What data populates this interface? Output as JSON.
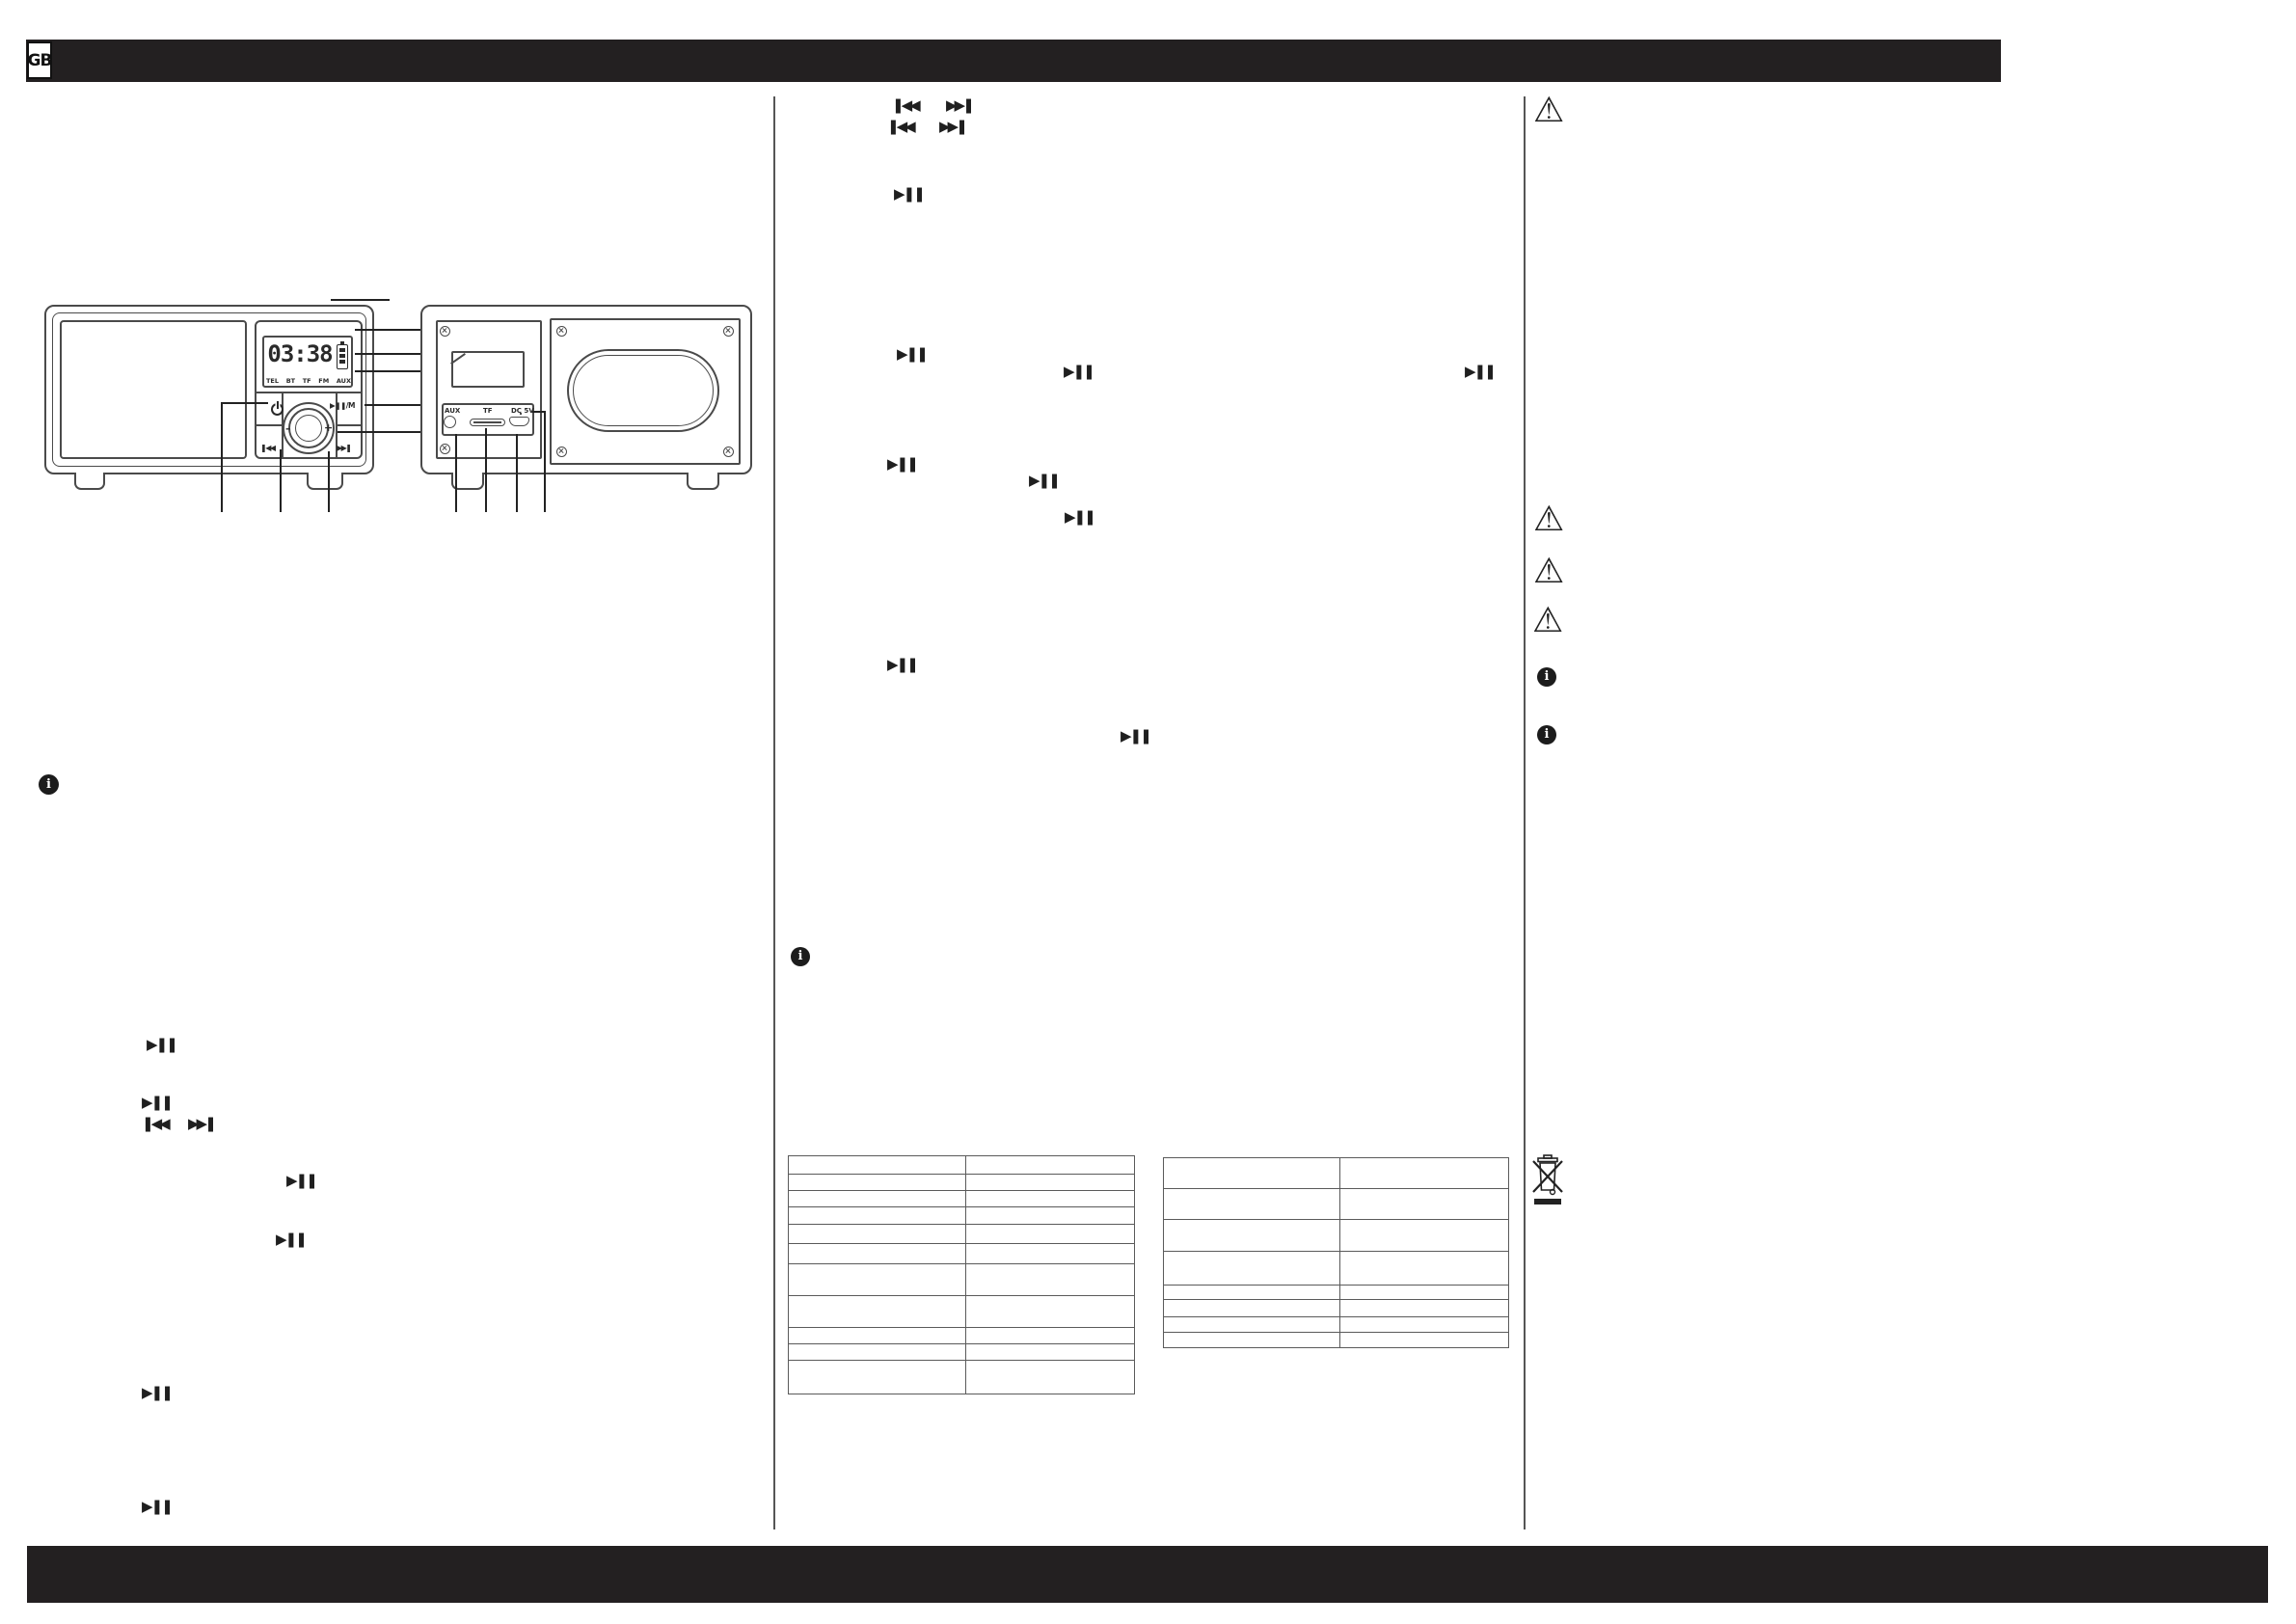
{
  "page": {
    "language_badge": "GB"
  },
  "glyphs": {
    "play_pause": "▶❚❚",
    "skip_back": "❚◀◀",
    "skip_forward": "▶▶❚",
    "info": "i",
    "warning": "⚠",
    "volume_minus": "–",
    "volume_plus": "+"
  },
  "device_front": {
    "lcd": {
      "time": "03:38",
      "mode_labels": [
        "TEL",
        "BT",
        "TF",
        "FM",
        "AUX"
      ]
    },
    "buttons": {
      "play_mode_label": "▶❚❚/M"
    }
  },
  "device_back": {
    "port_labels": [
      "AUX",
      "TF",
      "DC 5V"
    ]
  }
}
